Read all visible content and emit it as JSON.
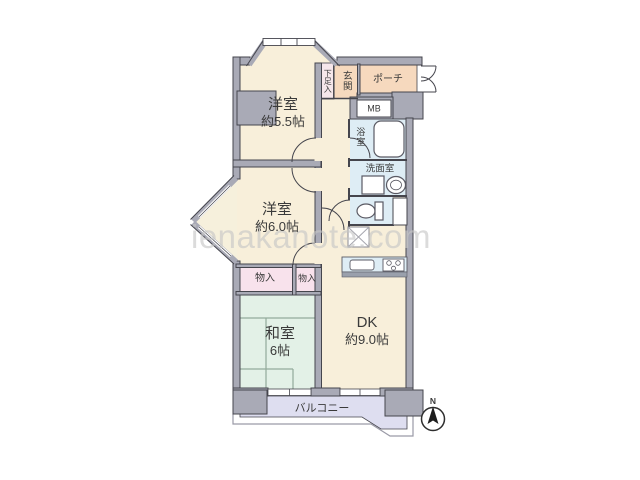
{
  "watermark": "ienakanote.com",
  "rooms": {
    "yoshitsu55": {
      "name": "洋室",
      "size": "約5.5帖"
    },
    "yoshitsu60": {
      "name": "洋室",
      "size": "約6.0帖"
    },
    "washitsu": {
      "name": "和室",
      "size": "6帖"
    },
    "dk": {
      "name": "DK",
      "size": "約9.0帖"
    },
    "balcony": {
      "label": "バルコニー"
    },
    "genkan": {
      "label": "玄関"
    },
    "porch": {
      "label": "ポーチ"
    },
    "shoe_box": {
      "label": "下足入"
    },
    "meter_box": {
      "label": "MB"
    },
    "bath": {
      "label": "浴室"
    },
    "washroom": {
      "label": "洗面室"
    },
    "closet_left": {
      "label": "物入"
    },
    "closet_right": {
      "label": "物入"
    }
  },
  "compass": {
    "label": "N"
  },
  "colors": {
    "wall": "#a9aab6",
    "outline": "#45454d",
    "room_cream": "#f8efda",
    "entry_peach": "#f6d9be",
    "wet_blue": "#deedf5",
    "tatami_green": "#e3f1e7",
    "closet_pink": "#f8e2ec",
    "shoe_pink": "#f6e7eb",
    "balcony_lavender": "#dedef0",
    "watermark_gray": "#c6c6c6"
  }
}
